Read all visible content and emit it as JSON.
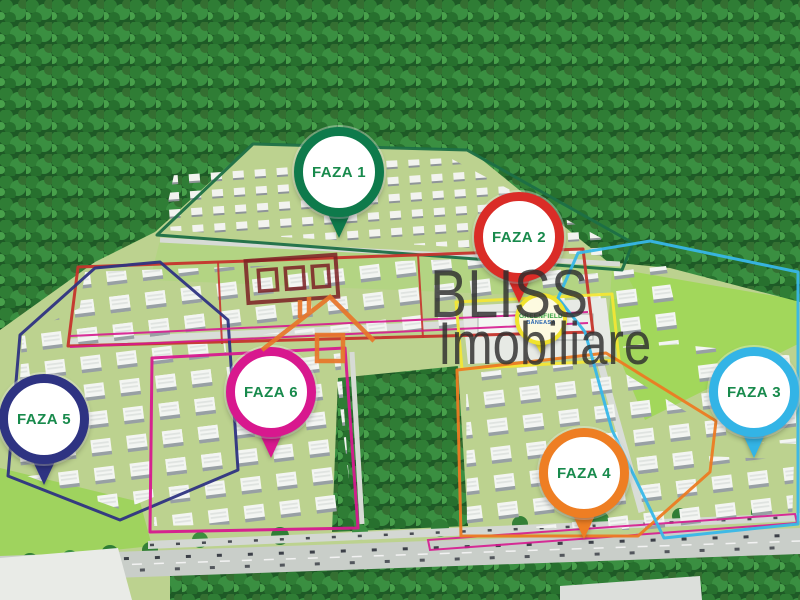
{
  "watermark": {
    "line1": "BLISS",
    "line2": "Imobiliare",
    "text_color": "#2e2e2e",
    "house_icon_color": "#e8762a",
    "building_icon_color": "#7c2024"
  },
  "pin_label_color": "#188a4c",
  "pins": {
    "faza1": {
      "label": "FAZA 1",
      "color": "#0e7a4b"
    },
    "faza2": {
      "label": "FAZA 2",
      "color": "#da2c27"
    },
    "faza3": {
      "label": "FAZA 3",
      "color": "#33b4e6"
    },
    "faza4": {
      "label": "FAZA 4",
      "color": "#ee7e23"
    },
    "faza5": {
      "label": "FAZA 5",
      "color": "#2e3382"
    },
    "faza6": {
      "label": "FAZA 6",
      "color": "#d8188e"
    },
    "greenfield": {
      "label": "GREENFIELD",
      "sublabel": "BĂNEASA",
      "color": "#f0e32e",
      "label_color": "#2f9e3c",
      "sublabel_color": "#2a66b0"
    }
  },
  "boundaries": {
    "faza1": "#1c6f46",
    "faza2": "#c5342c",
    "faza3": "#38b7e8",
    "faza4": "#ec7b23",
    "faza5": "#2e3382",
    "faza6": "#d6198f",
    "plaza": "#f2e636"
  }
}
